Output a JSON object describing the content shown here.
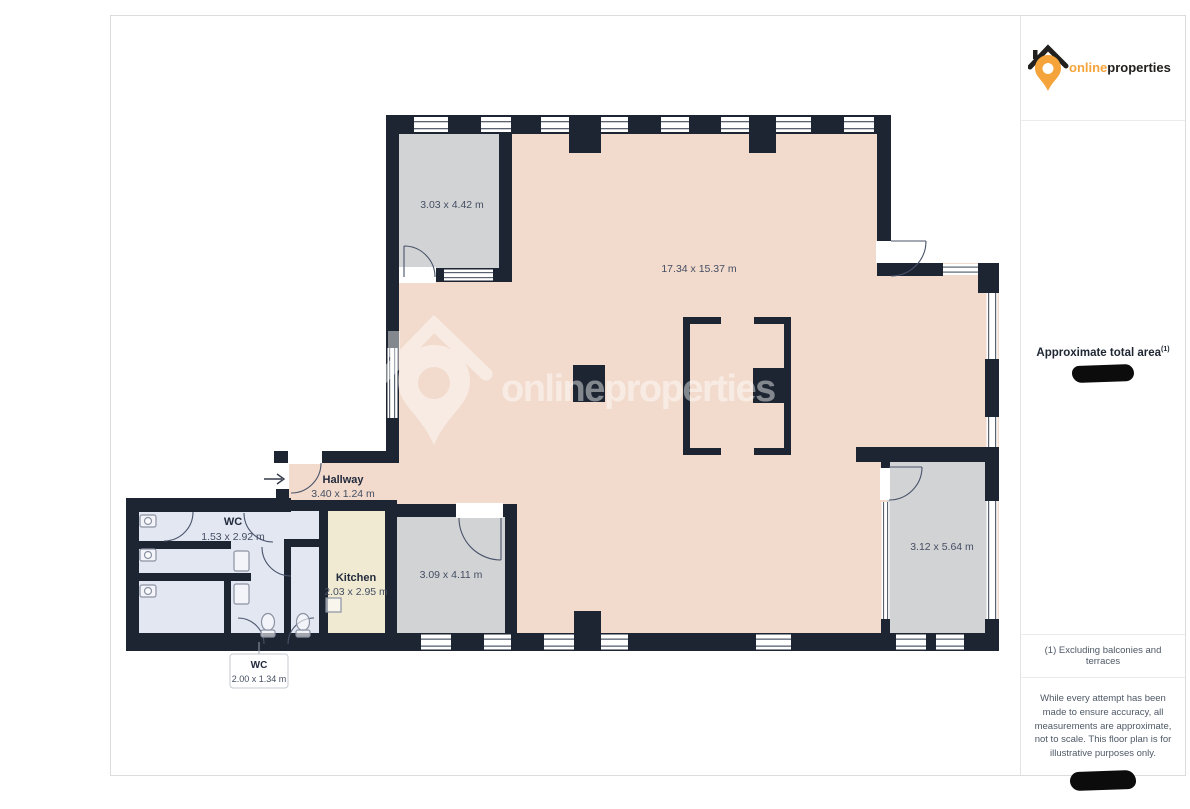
{
  "theme": {
    "wall": "#1d2532",
    "room-main": "#f2dbcd",
    "room-gray": "#d2d3d5",
    "room-wc": "#e3e7f2",
    "room-kitchen": "#f0ead3",
    "accent": "#f5a43b",
    "logo-dark": "#21201e"
  },
  "branding": {
    "name_primary": "online",
    "name_secondary": "properties"
  },
  "sidebar": {
    "area_label": "Approximate total area",
    "area_sup": "(1)",
    "footnote": "(1) Excluding balconies and terraces",
    "disclaimer": "While every attempt has been made to ensure accuracy, all measurements are approximate, not to scale. This floor plan is for illustrative purposes only."
  },
  "floorplan": {
    "rooms": {
      "top_left": {
        "dims": "3.03 x 4.42 m"
      },
      "main": {
        "dims": "17.34 x 15.37 m"
      },
      "hallway": {
        "name": "Hallway",
        "dims": "3.40 x 1.24 m"
      },
      "wc_main": {
        "name": "WC",
        "dims": "1.53 x 2.92 m"
      },
      "kitchen": {
        "name": "Kitchen",
        "dims": "2.03 x 2.95 m"
      },
      "bottom_gray": {
        "dims": "3.09 x 4.11 m"
      },
      "right_gray": {
        "dims": "3.12 x 5.64 m"
      },
      "wc_small": {
        "name": "WC",
        "dims": "2.00 x 1.34 m"
      }
    }
  }
}
